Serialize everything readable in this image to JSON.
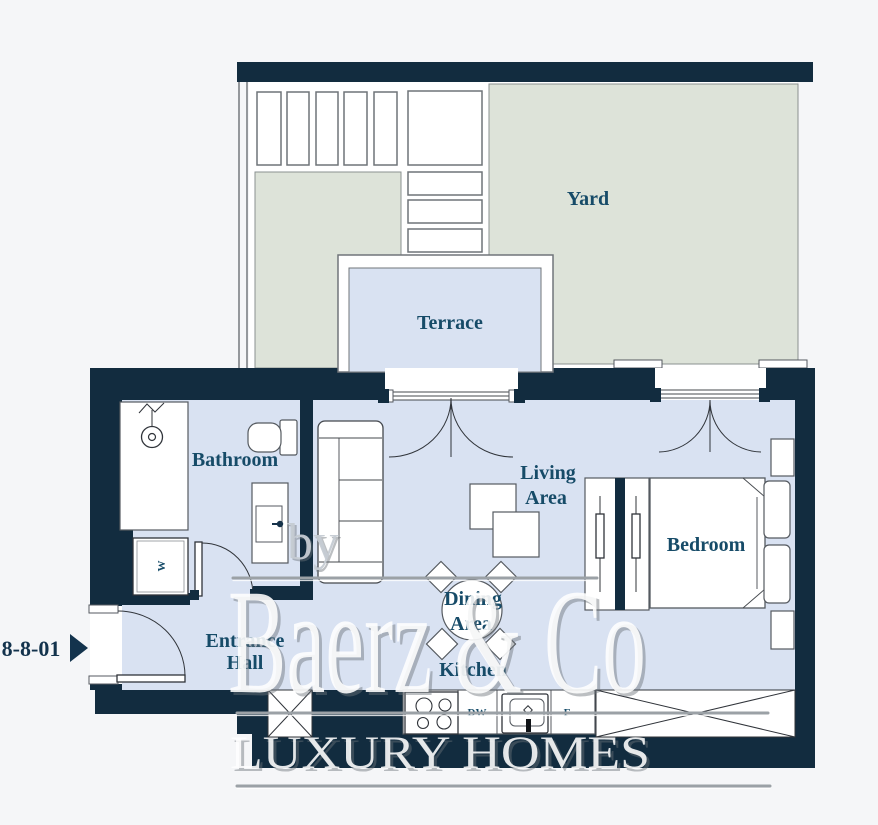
{
  "unit": {
    "label": "8-8-01"
  },
  "rooms": {
    "yard": "Yard",
    "terrace": "Terrace",
    "bathroom": "Bathroom",
    "living_area": {
      "line1": "Living",
      "line2": "Area"
    },
    "dining_area": {
      "line1": "Dining",
      "line2": "Area"
    },
    "kitchen": "Kitchen",
    "bedroom": "Bedroom",
    "entrance_hall": {
      "line1": "Entrance",
      "line2": "Hall"
    }
  },
  "appliances": {
    "washer": "W",
    "dishwasher": "DW",
    "fridge": "F"
  },
  "watermark": {
    "by": "by",
    "brand": "Baerz & Co",
    "tagline": "LUXURY HOMES"
  },
  "colors": {
    "wall": "#122c3f",
    "floor": "#d9e2f2",
    "yard": "#dde3d9",
    "label": "#164b68",
    "background": "#f5f6f8",
    "watermark": "#ffffff"
  }
}
